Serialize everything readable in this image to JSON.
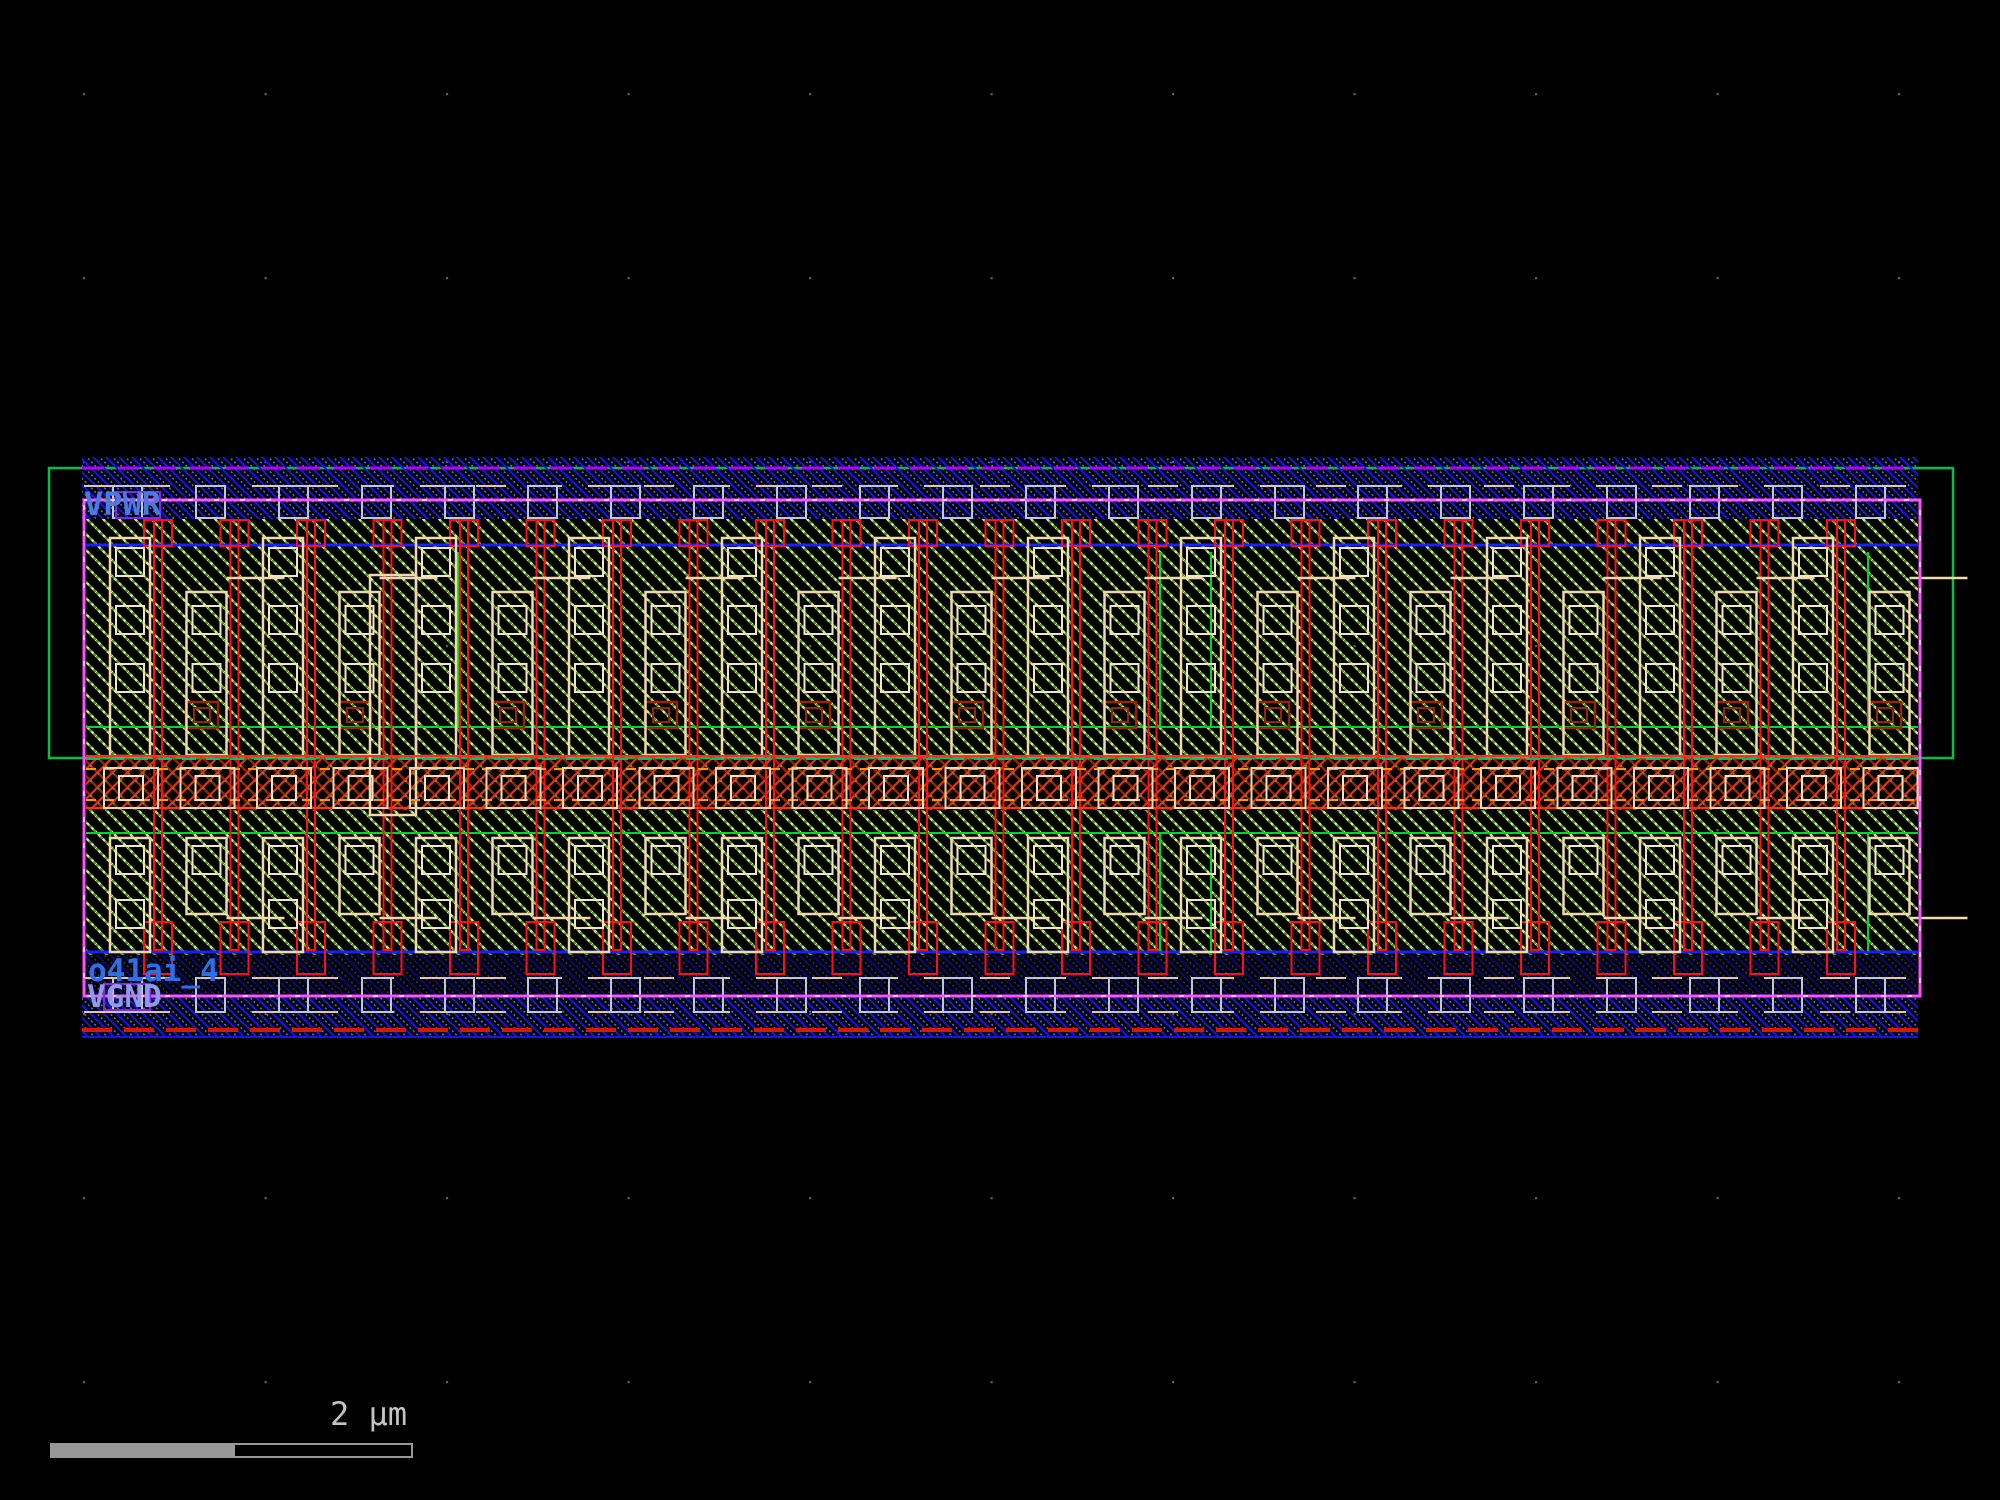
{
  "viewer": {
    "description": "IC layout viewer canvas showing standard cell",
    "cell_name": "o41ai_4"
  },
  "layout_labels": {
    "vpwr": "VPWR",
    "vgnd": "VGND",
    "cell_name": "o41ai_4"
  },
  "scale_bar": {
    "label": "2 μm"
  },
  "colors": {
    "background": "#000000",
    "grid_dot": "#5e5e5e",
    "nwell_green": "#00c04a",
    "inner_green": "#00d920",
    "metal_blue": "#1515e8",
    "metal_blue_dot": "#4868ff",
    "met1_blue_line": "#1822ff",
    "boundary_magenta": "#ff50ff",
    "pin_purple": "#8a20f0",
    "purple_dash": "#b400ff",
    "poly_red": "#ff1010",
    "li_tan": "#efd9ad",
    "licon_cream": "#f3e6c2",
    "contact_gray": "#c0c8d0",
    "tan_dash": "#e8c89a",
    "tap_dark_red": "#992400",
    "tap_bright_red": "#ff3010",
    "tap_green_dot": "#2f9e50",
    "teal_dash": "#00c080",
    "orange_dash": "#ff9500",
    "rail_red_dash": "#d81800",
    "diff_olive_bright": "#d2ec86",
    "diff_olive_dark": "#4e9e20",
    "label_blue": "#4a7ae0",
    "cell_label_blue": "#2e6fe8",
    "vgnd_label_blue": "#8f9ae8",
    "scale_gray": "#989898",
    "scale_text_gray": "#c4c4c4"
  }
}
